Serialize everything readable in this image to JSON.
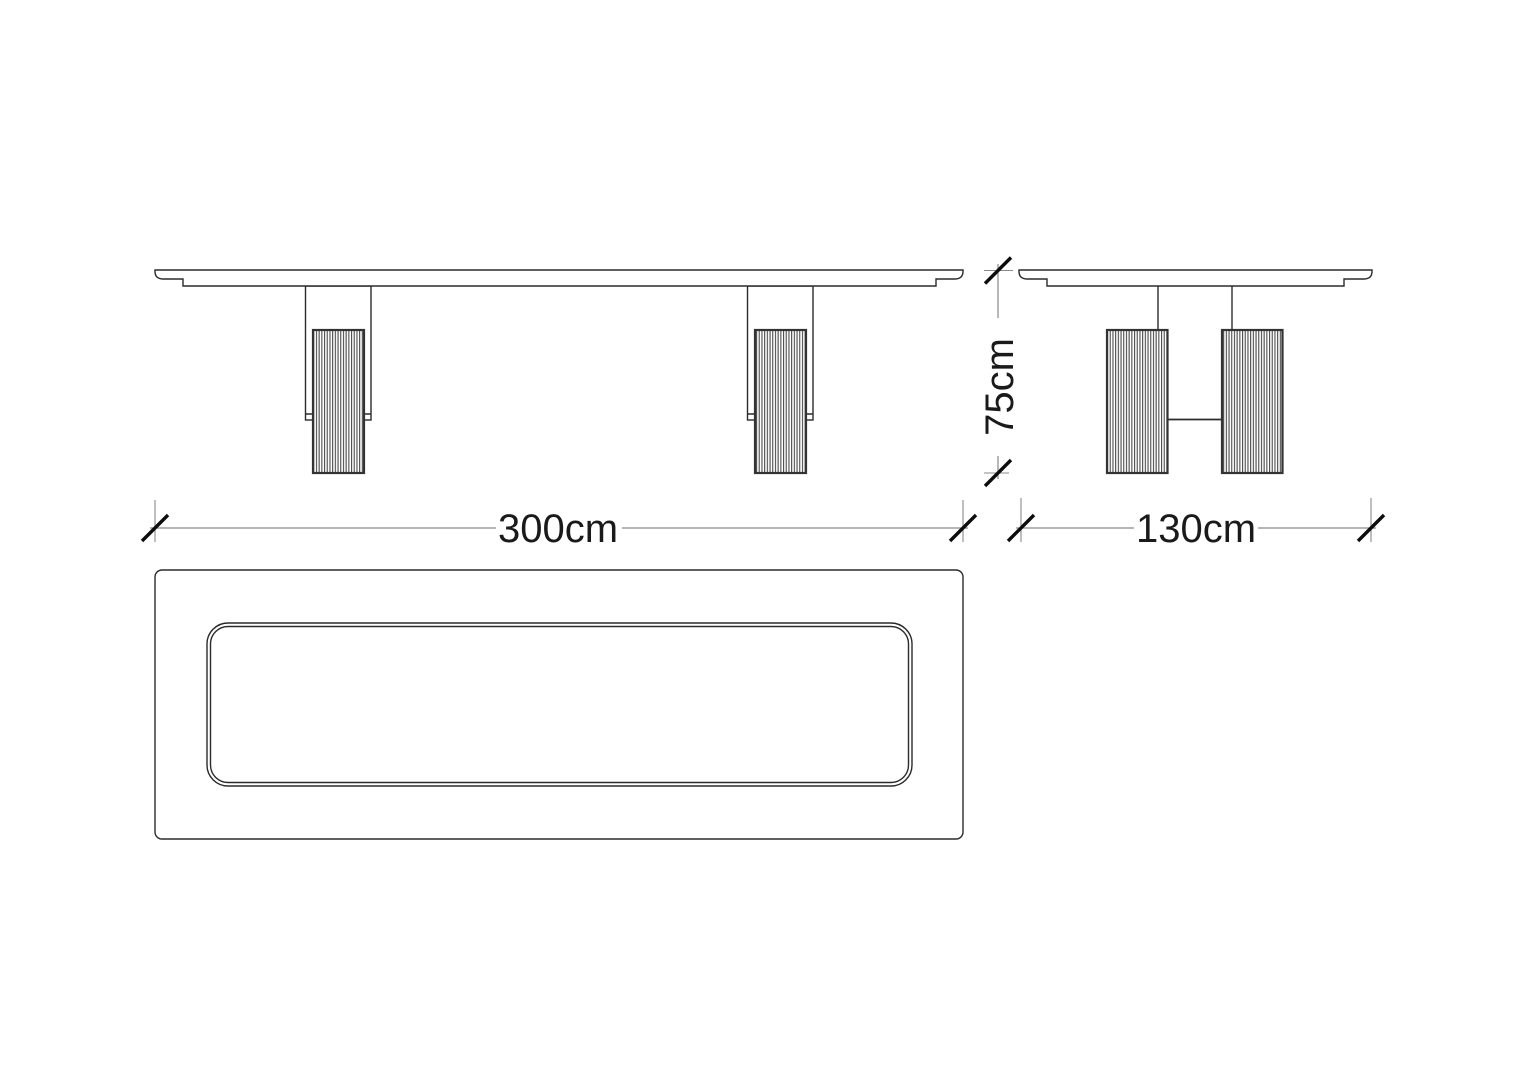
{
  "drawing": {
    "type": "furniture technical drawing - dining table, three orthographic views",
    "views": {
      "front": "front elevation with two fluted pedestal legs",
      "side": "side elevation with twin fluted columns and stretcher",
      "top": "plan view of rounded rectangular tabletop with recessed inner panel"
    },
    "dims": {
      "length": {
        "label": "300cm",
        "value": 300,
        "unit": "cm"
      },
      "depth": {
        "label": "130cm",
        "value": 130,
        "unit": "cm"
      },
      "height": {
        "label": "75cm",
        "value": 75,
        "unit": "cm"
      }
    },
    "colors": {
      "background": "#ffffff",
      "outline": "#2b2b2b",
      "column_border": "#333333",
      "hatch_stripe": "#4a4a4a",
      "dimension_line": "#8a8a8a",
      "tick": "#0d0d0d",
      "text": "#1a1a1a"
    }
  }
}
